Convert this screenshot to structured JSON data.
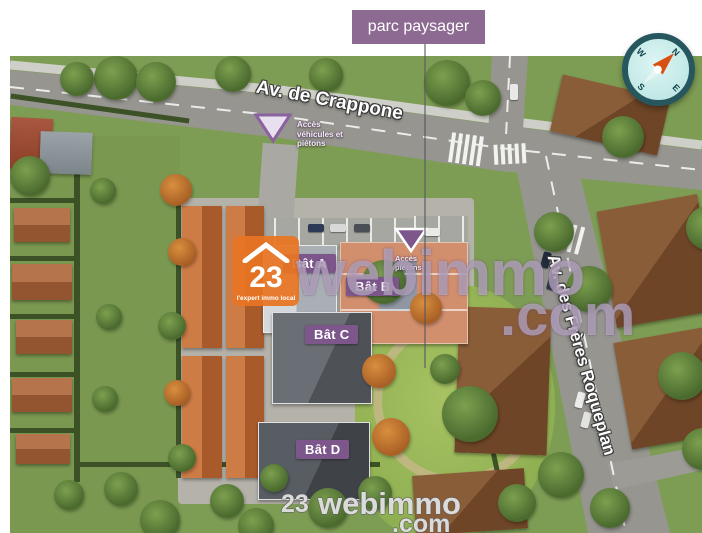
{
  "header": {
    "park_label": "parc paysager"
  },
  "map": {
    "streets": [
      {
        "name": "Av. de Crappone"
      },
      {
        "name": "Av. des Frères Roqueplan"
      }
    ],
    "buildings": [
      {
        "label": "Bât A"
      },
      {
        "label": "Bât B"
      },
      {
        "label": "Bât C"
      },
      {
        "label": "Bât D"
      }
    ],
    "access_points": [
      {
        "label": "Accès véhicules et piétons"
      },
      {
        "label": "Accès piétons"
      }
    ],
    "compass": {
      "north": "N",
      "east": "E",
      "south": "S",
      "west": "W"
    }
  },
  "watermark": {
    "logo_number": "23",
    "logo_tagline": "l'expert immo local",
    "brand": "webimmo",
    "tld": ".com"
  },
  "colors": {
    "label_purple": "#7d568b",
    "park_label_purple": "#8d6a92",
    "logo_orange": "#e8741f",
    "compass_rim": "#27575e",
    "compass_face": "#cdeeec",
    "needle_orange": "#d94f12",
    "road_gray": "#96958f"
  }
}
